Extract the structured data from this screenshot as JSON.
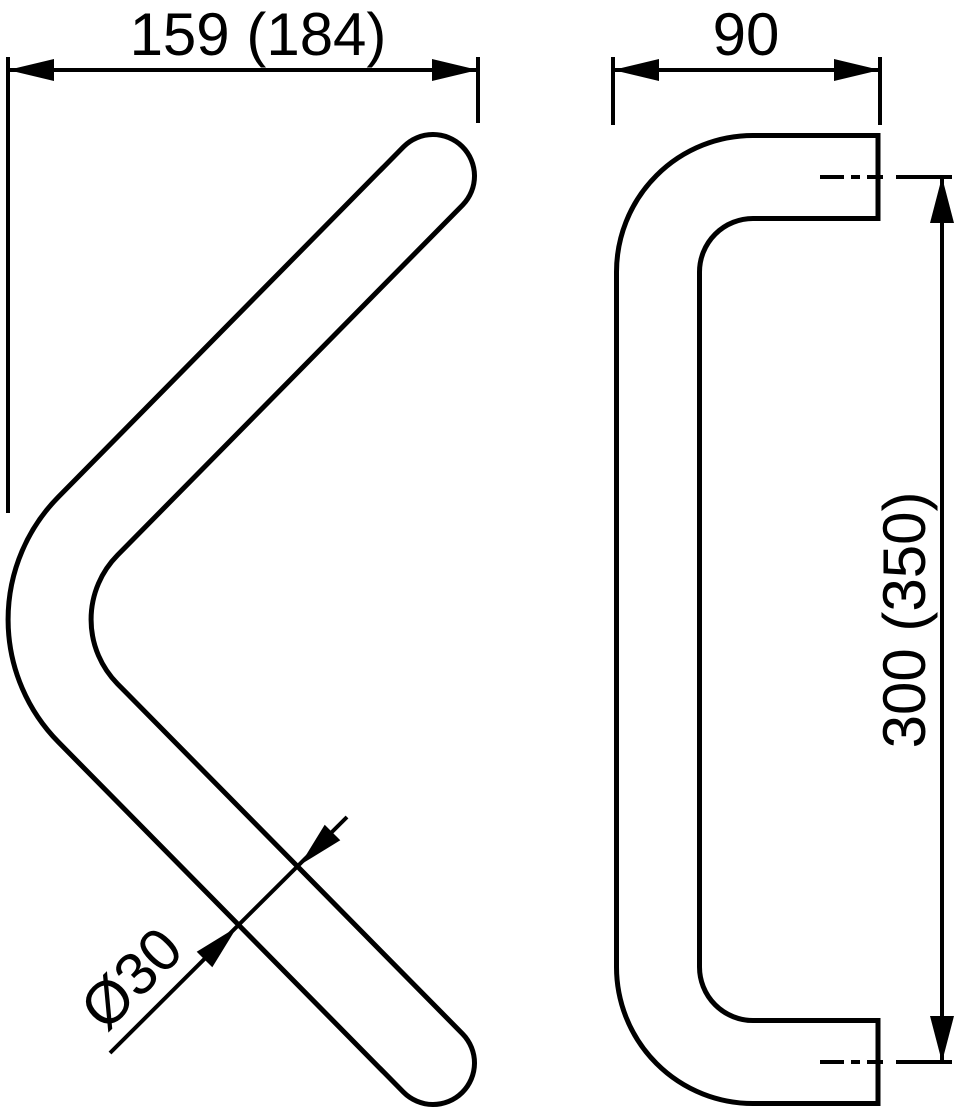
{
  "drawing": {
    "kind": "technical-dimension-drawing",
    "front_view": {
      "width_dimension": "159 (184)",
      "diameter_dimension": "Ø30"
    },
    "side_view": {
      "depth_dimension": "90",
      "height_dimension": "300 (350)"
    },
    "colors": {
      "line": "#000000",
      "background": "#ffffff"
    }
  }
}
